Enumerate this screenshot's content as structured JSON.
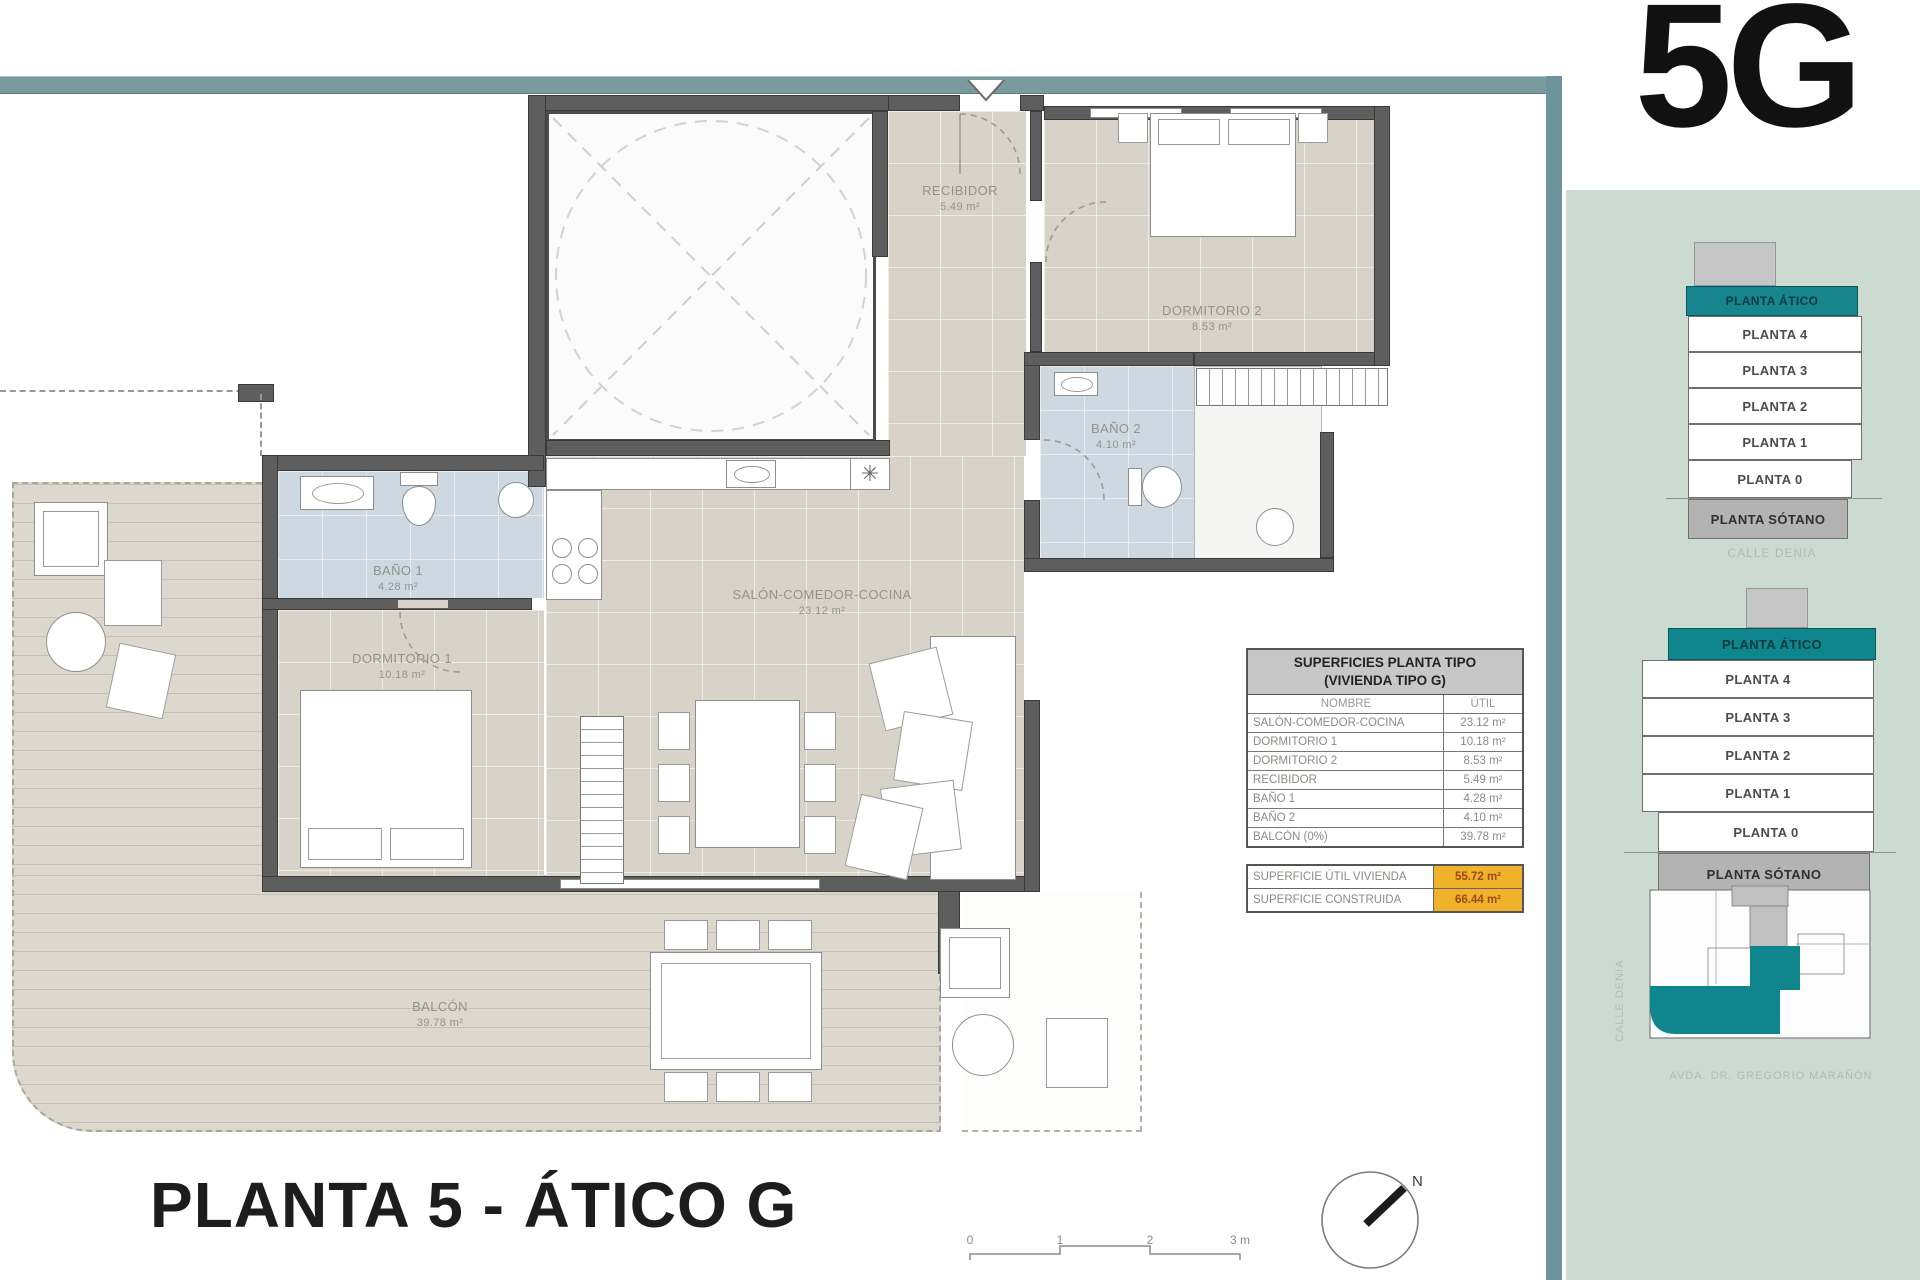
{
  "unit_label": "5G",
  "plan_title": "PLANTA 5 - ÁTICO G",
  "north_label": "N",
  "icons": {
    "snowflake": "✳"
  },
  "rooms": {
    "recibidor": {
      "name": "RECIBIDOR",
      "area": "5.49 m²"
    },
    "dormitorio2": {
      "name": "DORMITORIO 2",
      "area": "8.53 m²"
    },
    "bano2": {
      "name": "BAÑO 2",
      "area": "4.10 m²"
    },
    "bano1": {
      "name": "BAÑO 1",
      "area": "4.28 m²"
    },
    "salon": {
      "name": "SALÓN-COMEDOR-COCINA",
      "area": "23.12 m²"
    },
    "dormitorio1": {
      "name": "DORMITORIO 1",
      "area": "10.18 m²"
    },
    "balcon": {
      "name": "BALCÓN",
      "area": "39.78 m²"
    }
  },
  "surfaces_table": {
    "title_line1": "SUPERFICIES PLANTA TIPO",
    "title_line2": "(VIVIENDA TIPO G)",
    "col_name": "NOMBRE",
    "col_util": "ÚTIL",
    "rows": [
      {
        "name": "SALÓN-COMEDOR-COCINA",
        "util": "23.12 m²"
      },
      {
        "name": "DORMITORIO 1",
        "util": "10.18 m²"
      },
      {
        "name": "DORMITORIO 2",
        "util": "8.53 m²"
      },
      {
        "name": "RECIBIDOR",
        "util": "5.49 m²"
      },
      {
        "name": "BAÑO 1",
        "util": "4.28 m²"
      },
      {
        "name": "BAÑO 2",
        "util": "4.10 m²"
      },
      {
        "name": "BALCÓN (0%)",
        "util": "39.78 m²"
      }
    ],
    "totals": [
      {
        "name": "SUPERFICIE ÚTIL VIVIENDA",
        "value": "55.72 m²"
      },
      {
        "name": "SUPERFICIE CONSTRUIDA",
        "value": "66.44 m²"
      }
    ]
  },
  "scale_bar": {
    "t0": "0",
    "t1": "1",
    "t2": "2",
    "t3": "3 m"
  },
  "stacks": {
    "levels": [
      "PLANTA ÁTICO",
      "PLANTA 4",
      "PLANTA 3",
      "PLANTA 2",
      "PLANTA 1",
      "PLANTA 0",
      "PLANTA SÓTANO"
    ],
    "caption_small": "CALLE DENIA",
    "caption_large": "AVDA. DR. GREGORIO MARAÑÓN"
  },
  "site_plan": {
    "street_left": "CALLE DENIA",
    "street_bottom": "AVDA. DR. GREGORIO MARAÑÓN"
  },
  "colors": {
    "accent_teal": "#17858e",
    "border_teal": "#6d949a",
    "panel_bg": "#ccdbd2",
    "highlight": "#f0b12b"
  }
}
